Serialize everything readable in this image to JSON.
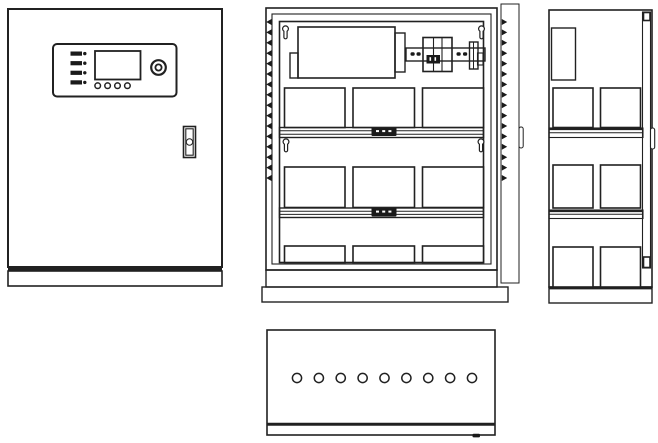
{
  "canvas": {
    "width": 658,
    "height": 443,
    "background": "#ffffff",
    "line_color": "#212121",
    "dark_fill_color": "#1a1a1a"
  },
  "views": {
    "front": {
      "id": "front-view",
      "kind": "cabinet-front-closed-door",
      "indicator_led_count": 4,
      "button_count": 4,
      "has_lcd_display": true,
      "has_round_indicator": true,
      "has_door_lock_handle": true
    },
    "internal": {
      "id": "internal-view",
      "kind": "cabinet-front-door-open",
      "gasket_tooth_count": 16,
      "mounting_keyhole_count": 4,
      "battery_rows": [
        3,
        3,
        3
      ],
      "shelf_count": 2,
      "terminal_block_count": 2,
      "terminal_block_dash_count": 3,
      "din_rail_slot_count": 4,
      "has_circuit_breaker": true,
      "has_power_supply_unit": true,
      "has_open_door_panel": true
    },
    "side": {
      "id": "side-view",
      "kind": "cabinet-side",
      "battery_rows": [
        2,
        2,
        2
      ],
      "shelf_count": 2,
      "has_door_edge_strip": true,
      "has_handle_bump": true
    },
    "bottom": {
      "id": "bottom-view",
      "kind": "cabinet-bottom",
      "cable_hole_count": 9,
      "has_front_edge_line": true,
      "has_drain_notch": true
    }
  }
}
